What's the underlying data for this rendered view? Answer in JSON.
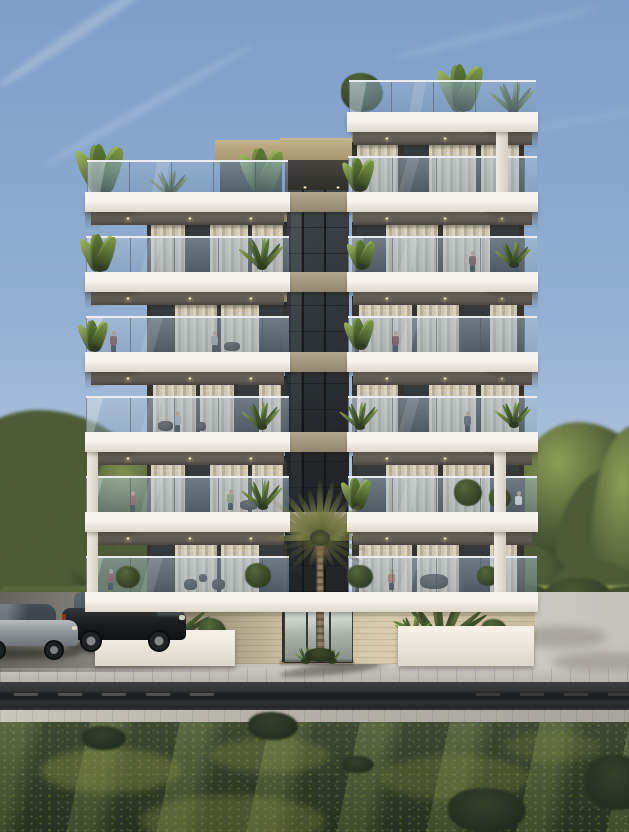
{
  "meta": {
    "description": "3D architectural render of a modern white apartment building at dusk",
    "width": 629,
    "height": 832
  },
  "palette": {
    "sky_top": "#7e9dc8",
    "sky_mid": "#93afd3",
    "sky_low": "#bccde0",
    "sky_haze": "#d8e2e5",
    "sky_horizon": "#e6e7db",
    "slab_top": "#f7f4ed",
    "slab_bot": "#ded8cb",
    "soffit": "#5d5850",
    "soffit_dark": "#4a463f",
    "backwall_tan": "#94876a",
    "frame_dark": "#34332e",
    "glass_top": "#3a3f42",
    "glass_bot": "#26292b",
    "curtain_a": "#dad2c0",
    "curtain_b": "#b9ae99",
    "curtain_c": "#cfc6b2",
    "rail_glass_a": "rgba(170,192,209,0.50)",
    "rail_glass_b": "rgba(128,154,175,0.42)",
    "handrail": "rgba(238,242,244,0.95)",
    "post": "rgba(78,88,98,0.55)",
    "roof_glass_a": "rgba(148,176,204,0.55)",
    "roof_glass_b": "rgba(118,146,174,0.45)",
    "conn_glass_top": "#3d4347",
    "conn_glass_bot": "#222528",
    "conn_spandrel_a": "#b3a78e",
    "conn_spandrel_b": "#92886f",
    "parapet_a": "#c6b68e",
    "parapet_b": "#a3926c",
    "stone_a": "#ab9f85",
    "stone_b": "#c9bc9f",
    "stone_c": "#d9ccae",
    "planter_a": "#f4f0e6",
    "planter_b": "#ddd7c9",
    "lot_a": "#8f8d86",
    "lot_b": "#c5c2bb",
    "lot_c": "#d2cfc7",
    "sidewalk": "#b7b4ac",
    "road_a": "#3c3d3f",
    "road_b": "#2e2f31",
    "paver": "#b6b3a9",
    "grass_a": "#4e5a40",
    "grass_b": "#39452e",
    "grass_c": "#2e3826",
    "tree_lit": "#7f9150",
    "tree_mid": "#4d5c37",
    "tree_dark": "#2f3b26",
    "tree_lit_warm": "#8d9e55",
    "hedge": "#465434",
    "sun_grass": "#93a156",
    "wall_white": "#e9e5d9",
    "palm_frond": "#767b46",
    "palm_frond_dark": "#51562f",
    "palm_dead": "#7a6a47",
    "trunk_a": "#93856a",
    "trunk_b": "#6e624c",
    "suv_body_a": "#33383d",
    "suv_body_b": "#0f1113",
    "sedan_a": "#b8bcbe",
    "sedan_b": "#6f7478",
    "skin": "#b98f74",
    "downlight": "#fff3cf"
  },
  "sky": {
    "stops": [
      [
        0,
        "#7e9dc8"
      ],
      [
        38,
        "#93afd3"
      ],
      [
        66,
        "#bccde0"
      ],
      [
        84,
        "#d8e2e5"
      ],
      [
        100,
        "#e6e7db"
      ]
    ],
    "clouds": [
      {
        "x": -20,
        "y": 22,
        "w": 210,
        "h": 12,
        "rot": -34,
        "op": 0.22
      },
      {
        "x": 30,
        "y": 100,
        "w": 240,
        "h": 9,
        "rot": -30,
        "op": 0.14
      },
      {
        "x": 390,
        "y": 28,
        "w": 210,
        "h": 10,
        "rot": -14,
        "op": 0.1
      },
      {
        "x": 470,
        "y": 120,
        "w": 180,
        "h": 8,
        "rot": -10,
        "op": 0.08
      }
    ],
    "haze": {
      "x": 0,
      "y": 540,
      "w": 629,
      "h": 80
    }
  },
  "trees_left": {
    "blobs": [
      [
        -50,
        410,
        190,
        150,
        0
      ],
      [
        -30,
        470,
        150,
        130,
        0
      ],
      [
        50,
        498,
        132,
        112,
        0
      ],
      [
        92,
        450,
        95,
        85,
        1
      ],
      [
        15,
        538,
        125,
        92,
        0
      ],
      [
        112,
        515,
        85,
        95,
        0
      ],
      [
        -20,
        560,
        110,
        70,
        0
      ]
    ],
    "trunk": [
      160,
      468,
      6,
      130
    ]
  },
  "trees_right": {
    "blobs": [
      [
        468,
        458,
        122,
        122,
        0
      ],
      [
        515,
        422,
        135,
        142,
        1
      ],
      [
        556,
        468,
        125,
        162,
        0
      ],
      [
        592,
        425,
        95,
        205,
        1
      ],
      [
        476,
        545,
        92,
        72,
        0
      ],
      [
        545,
        560,
        100,
        80,
        0
      ]
    ],
    "trunk": [
      597,
      588,
      6,
      60
    ]
  },
  "hedges": {
    "left_band": [
      0,
      586,
      232,
      28
    ],
    "left_lit": [
      0,
      596,
      150,
      15
    ],
    "right_sun_grass": [
      488,
      586,
      141,
      28
    ],
    "right_bushes": [
      [
        492,
        583,
        62,
        38
      ],
      [
        542,
        578,
        72,
        42
      ],
      [
        596,
        586,
        62,
        36
      ]
    ],
    "right_wall": [
      487,
      612,
      142,
      30
    ]
  },
  "ground": {
    "back_lot": [
      0,
      592,
      629,
      80
    ],
    "sidewalk": [
      0,
      668,
      629,
      14
    ],
    "road": [
      0,
      682,
      629,
      28
    ],
    "dashes_left": [
      [
        14,
        693
      ],
      [
        58,
        693
      ],
      [
        102,
        693
      ],
      [
        146,
        693
      ],
      [
        190,
        693
      ]
    ],
    "dashes_right": [
      [
        476,
        693
      ],
      [
        520,
        693
      ],
      [
        564,
        693
      ],
      [
        608,
        693
      ]
    ],
    "paver_band": [
      0,
      710,
      629,
      13
    ],
    "grass": [
      0,
      722,
      629,
      110
    ],
    "grass_patches": [
      [
        40,
        748,
        140,
        45,
        0.4
      ],
      [
        210,
        738,
        120,
        35,
        0.32
      ],
      [
        380,
        755,
        150,
        45,
        0.28
      ],
      [
        140,
        795,
        185,
        52,
        0.33
      ],
      [
        505,
        732,
        95,
        30,
        0.22
      ]
    ],
    "grass_tufts": [
      [
        82,
        726,
        44,
        24
      ],
      [
        248,
        712,
        50,
        28
      ],
      [
        448,
        788,
        78,
        44
      ],
      [
        585,
        755,
        65,
        55
      ],
      [
        342,
        756,
        32,
        17
      ]
    ]
  },
  "shadows": {
    "lot_left": [
      0,
      592,
      250,
      80
    ],
    "lot_blotches": [
      [
        392,
        636,
        120,
        26
      ],
      [
        512,
        626,
        95,
        22
      ],
      [
        552,
        652,
        105,
        20
      ],
      [
        300,
        655,
        90,
        16
      ]
    ],
    "palm_shadow": [
      280,
      664,
      100,
      11
    ],
    "car_suv": [
      66,
      640,
      122,
      14
    ],
    "car_sedan": [
      -26,
      648,
      106,
      11
    ]
  },
  "building": {
    "penthouse": {
      "block": [
        215,
        140,
        72,
        24
      ],
      "glazing": [
        220,
        160,
        62,
        32
      ]
    },
    "connector": {
      "x": 285,
      "w": 64,
      "top": 160,
      "bottom": 592,
      "parapet": [
        280,
        138,
        74,
        24
      ],
      "terrace_dark": [
        285,
        160,
        64,
        34
      ],
      "terrace_lights": [
        [
          303,
          186
        ],
        [
          336,
          186
        ]
      ],
      "spandrel_ys": [
        192,
        272,
        352,
        432,
        512
      ],
      "mullion_xs": [
        302,
        324
      ]
    },
    "left_tower": {
      "slab_x": 85,
      "slab_w": 205,
      "facade_x": 147,
      "facade_w": 140,
      "roof_glass_y": 160,
      "band_ys": [
        192,
        272,
        352,
        432,
        512
      ],
      "wedge_side": "left",
      "roof_plants": [
        {
          "x": 102,
          "y": 192,
          "h": 48,
          "kind": "banana"
        },
        {
          "x": 170,
          "y": 196,
          "h": 26,
          "kind": "agave"
        },
        {
          "x": 263,
          "y": 192,
          "h": 44,
          "kind": "banana"
        }
      ],
      "columns": [
        [
          87,
          452,
          11,
          140
        ]
      ],
      "openings": [
        {
          "y": 212,
          "pattern": 0,
          "tan_top": true,
          "plants": [
            {
              "x": 100,
              "y": 270,
              "h": 36,
              "kind": "banana"
            },
            {
              "x": 262,
              "y": 268,
              "h": 30,
              "kind": "agave"
            }
          ],
          "people": [],
          "furniture": []
        },
        {
          "y": 292,
          "pattern": 1,
          "tan_top": true,
          "plants": [
            {
              "x": 95,
              "y": 350,
              "h": 30,
              "kind": "banana"
            }
          ],
          "people": [
            {
              "x": 113,
              "foot": 352,
              "c": "#7b3a35"
            },
            {
              "x": 214,
              "foot": 352,
              "c": "#9a9ea1"
            }
          ],
          "furniture": [
            {
              "x": 224,
              "y": 342,
              "w": 16,
              "h": 9
            }
          ]
        },
        {
          "y": 372,
          "pattern": 2,
          "tan_top": false,
          "plants": [
            {
              "x": 262,
              "y": 428,
              "h": 26,
              "kind": "agave"
            }
          ],
          "people": [
            {
              "x": 177,
              "foot": 432,
              "c": "#a9adb0"
            }
          ],
          "furniture": [
            {
              "x": 158,
              "y": 421,
              "w": 15,
              "h": 10
            },
            {
              "x": 196,
              "y": 422,
              "w": 10,
              "h": 9
            }
          ]
        },
        {
          "y": 452,
          "pattern": 0,
          "tan_top": false,
          "plants": [
            {
              "x": 263,
              "y": 508,
              "h": 28,
              "kind": "agave"
            }
          ],
          "people": [
            {
              "x": 132,
              "foot": 512,
              "c": "#8a4a40"
            },
            {
              "x": 230,
              "foot": 510,
              "c": "#8f9268"
            }
          ],
          "furniture": [
            {
              "x": 240,
              "y": 500,
              "w": 18,
              "h": 10
            }
          ]
        },
        {
          "y": 532,
          "pattern": 1,
          "tan_top": false,
          "plants": [
            {
              "x": 128,
              "y": 588,
              "h": 28,
              "kind": "bush"
            },
            {
              "x": 258,
              "y": 588,
              "h": 32,
              "kind": "bush"
            }
          ],
          "people": [
            {
              "x": 110,
              "foot": 590,
              "c": "#7b3a35"
            }
          ],
          "furniture": [
            {
              "x": 184,
              "y": 579,
              "w": 13,
              "h": 11
            },
            {
              "x": 212,
              "y": 579,
              "w": 13,
              "h": 11
            },
            {
              "x": 199,
              "y": 574,
              "w": 8,
              "h": 8
            }
          ]
        }
      ]
    },
    "right_tower": {
      "slab_x": 347,
      "slab_w": 191,
      "facade_x": 352,
      "facade_w": 172,
      "roof_glass_y": 80,
      "band_ys": [
        112,
        192,
        272,
        352,
        432,
        512
      ],
      "wedge_side": "right",
      "roof_plants": [
        {
          "x": 362,
          "y": 112,
          "h": 50,
          "kind": "bush"
        },
        {
          "x": 463,
          "y": 110,
          "h": 46,
          "kind": "banana"
        },
        {
          "x": 513,
          "y": 112,
          "h": 30,
          "kind": "agave"
        }
      ],
      "columns": [
        [
          496,
          132,
          12,
          60
        ],
        [
          494,
          452,
          12,
          140
        ]
      ],
      "openings": [
        {
          "y": 132,
          "pattern": 0,
          "tan_top": true,
          "plants": [
            {
              "x": 360,
              "y": 190,
              "h": 32,
              "kind": "banana"
            }
          ],
          "people": [],
          "furniture": []
        },
        {
          "y": 212,
          "pattern": 1,
          "tan_top": true,
          "plants": [
            {
              "x": 362,
              "y": 268,
              "h": 28,
              "kind": "banana"
            },
            {
              "x": 514,
              "y": 266,
              "h": 24,
              "kind": "agave"
            }
          ],
          "people": [
            {
              "x": 472,
              "foot": 272,
              "c": "#6e3a33"
            }
          ],
          "furniture": []
        },
        {
          "y": 292,
          "pattern": 2,
          "tan_top": false,
          "plants": [
            {
              "x": 361,
              "y": 348,
              "h": 30,
              "kind": "banana"
            }
          ],
          "people": [
            {
              "x": 395,
              "foot": 352,
              "c": "#70312c"
            }
          ],
          "furniture": []
        },
        {
          "y": 372,
          "pattern": 0,
          "tan_top": false,
          "plants": [
            {
              "x": 360,
              "y": 428,
              "h": 26,
              "kind": "agave"
            },
            {
              "x": 514,
              "y": 426,
              "h": 24,
              "kind": "agave"
            }
          ],
          "people": [
            {
              "x": 467,
              "foot": 432,
              "c": "#4a4a4f"
            }
          ],
          "furniture": []
        },
        {
          "y": 452,
          "pattern": 1,
          "tan_top": false,
          "plants": [
            {
              "x": 358,
              "y": 508,
              "h": 30,
              "kind": "banana"
            },
            {
              "x": 468,
              "y": 506,
              "h": 34,
              "kind": "bush"
            },
            {
              "x": 500,
              "y": 508,
              "h": 26,
              "kind": "bush"
            }
          ],
          "people": [
            {
              "x": 518,
              "foot": 512,
              "c": "#e3e1da"
            }
          ],
          "furniture": []
        },
        {
          "y": 532,
          "pattern": 2,
          "tan_top": false,
          "plants": [
            {
              "x": 360,
              "y": 588,
              "h": 30,
              "kind": "bush"
            },
            {
              "x": 488,
              "y": 586,
              "h": 26,
              "kind": "bush"
            }
          ],
          "people": [
            {
              "x": 391,
              "foot": 590,
              "c": "#b56a55"
            }
          ],
          "furniture": [
            {
              "x": 420,
              "y": 574,
              "w": 28,
              "h": 15
            }
          ]
        }
      ]
    },
    "bottom_band": [
      85,
      592,
      453,
      20
    ],
    "ground_floor": {
      "stone": [
        145,
        612,
        390,
        52
      ],
      "entrance": {
        "recess": [
          282,
          600,
          70,
          62
        ],
        "transom": [
          282,
          600,
          70,
          8
        ],
        "door_xs": [
          284,
          307,
          330
        ],
        "door_w": 21,
        "door_y": 609,
        "door_h": 52
      }
    }
  },
  "planters": {
    "left": {
      "box": [
        95,
        630,
        140,
        36
      ],
      "plants": [
        {
          "x": 163,
          "y": 648,
          "h": 56,
          "kind": "fanpalm"
        },
        {
          "x": 118,
          "y": 645,
          "h": 30,
          "kind": "agave"
        },
        {
          "x": 212,
          "y": 645,
          "h": 34,
          "kind": "bush"
        }
      ]
    },
    "right": {
      "box": [
        398,
        626,
        136,
        40
      ],
      "plants": [
        {
          "x": 442,
          "y": 645,
          "h": 54,
          "kind": "fanpalm"
        },
        {
          "x": 494,
          "y": 642,
          "h": 30,
          "kind": "bush"
        },
        {
          "x": 414,
          "y": 640,
          "h": 24,
          "kind": "agave"
        }
      ]
    },
    "palm_base_plants": [
      {
        "x": 306,
        "y": 662,
        "h": 15,
        "kind": "agave"
      },
      {
        "x": 332,
        "y": 662,
        "h": 13,
        "kind": "agave"
      }
    ]
  },
  "palm": {
    "cx": 320,
    "cy": 538,
    "trunk_bottom": 660,
    "n_fronds": 15,
    "len_min": 46,
    "len_max": 62,
    "drooper_angles": [
      14,
      166,
      30,
      150,
      47,
      133
    ],
    "dead_angles": [
      62,
      79,
      96,
      112
    ]
  },
  "vehicles": {
    "suv": {
      "x": 62,
      "y": 586,
      "w": 126,
      "h": 70
    },
    "sedan": {
      "x": -30,
      "y": 602,
      "w": 110,
      "h": 62
    }
  }
}
